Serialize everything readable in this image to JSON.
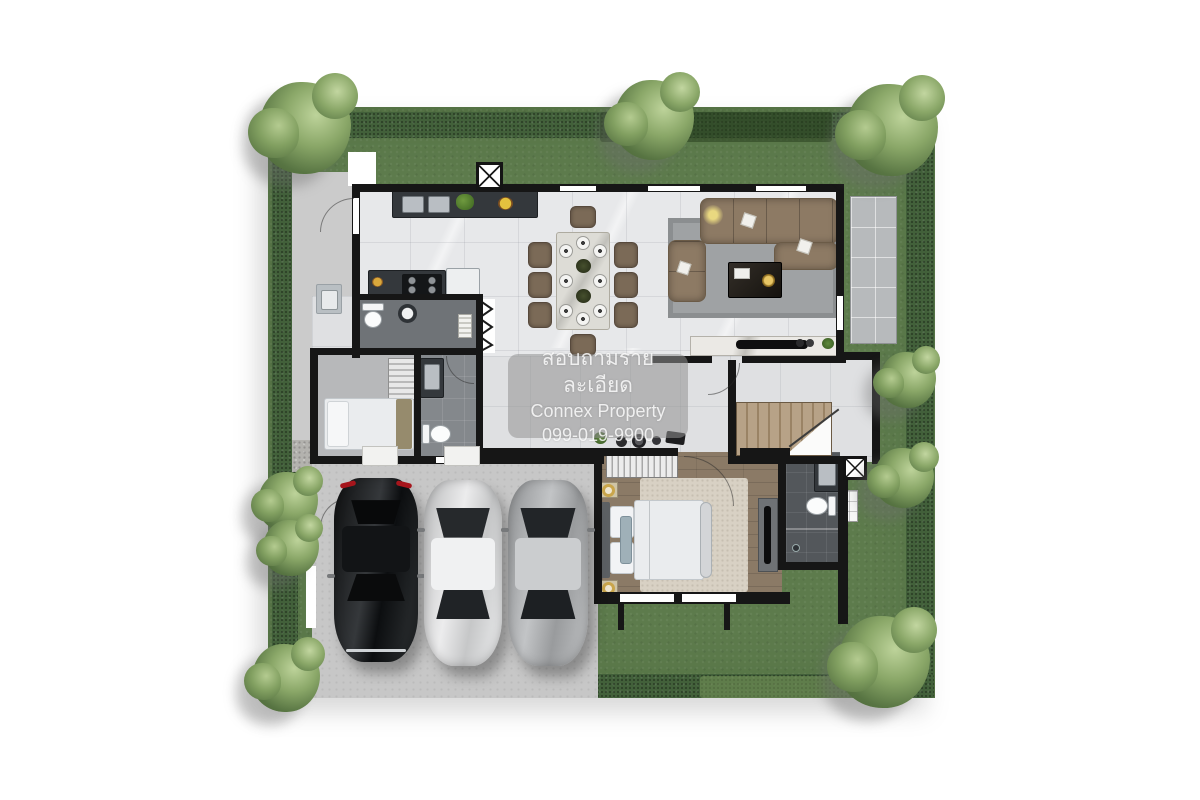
{
  "watermark": {
    "line1": "สอบถามรายละเอียด",
    "line2": "Connex Property",
    "line3": "099-019-9900"
  },
  "palette": {
    "lawn": "#5d7b4c",
    "hedge": "#42603a",
    "wall": "#161616",
    "marble": "#e7e8ea",
    "marble2": "#dfe0e2",
    "wood": "#8b7a66",
    "concrete": "#c7c7c7",
    "walkway": "#b3b2ae",
    "terrace": "#b7babc",
    "darktile": "#53575b",
    "midtile": "#84888c",
    "sofa": "#8d7a64",
    "rug": "#9fa2a4",
    "bedrug": "#d8d1c4",
    "stairwood": "#b7a287",
    "gold": "#c9a54b",
    "car_black": "#17191b",
    "car_silver": "#d8d9da",
    "car_gray": "#a8aaac",
    "wm_bg": "rgba(145,145,145,0.55)"
  },
  "scene": {
    "type": "house-floor-plan-top-view",
    "rooms": [
      {
        "name": "kitchen"
      },
      {
        "name": "dining-area"
      },
      {
        "name": "living-room"
      },
      {
        "name": "entrance-foyer"
      },
      {
        "name": "hallway"
      },
      {
        "name": "staircase"
      },
      {
        "name": "utility-bathroom"
      },
      {
        "name": "maid-bedroom"
      },
      {
        "name": "maid-bathroom"
      },
      {
        "name": "master-bedroom"
      },
      {
        "name": "master-bathroom"
      },
      {
        "name": "garage-carport"
      },
      {
        "name": "driveway"
      },
      {
        "name": "side-service-yard"
      },
      {
        "name": "terrace"
      },
      {
        "name": "garden-lawn"
      }
    ],
    "vehicles": [
      {
        "name": "black-sedan"
      },
      {
        "name": "silver-sedan"
      },
      {
        "name": "gray-sedan"
      }
    ],
    "furniture_counts": {
      "dining_chairs": 8,
      "dining_plates": 8,
      "sofas": 2,
      "beds": 2,
      "toilets": 3,
      "sinks": 4,
      "trees": 9,
      "wardrobes": 2
    }
  }
}
